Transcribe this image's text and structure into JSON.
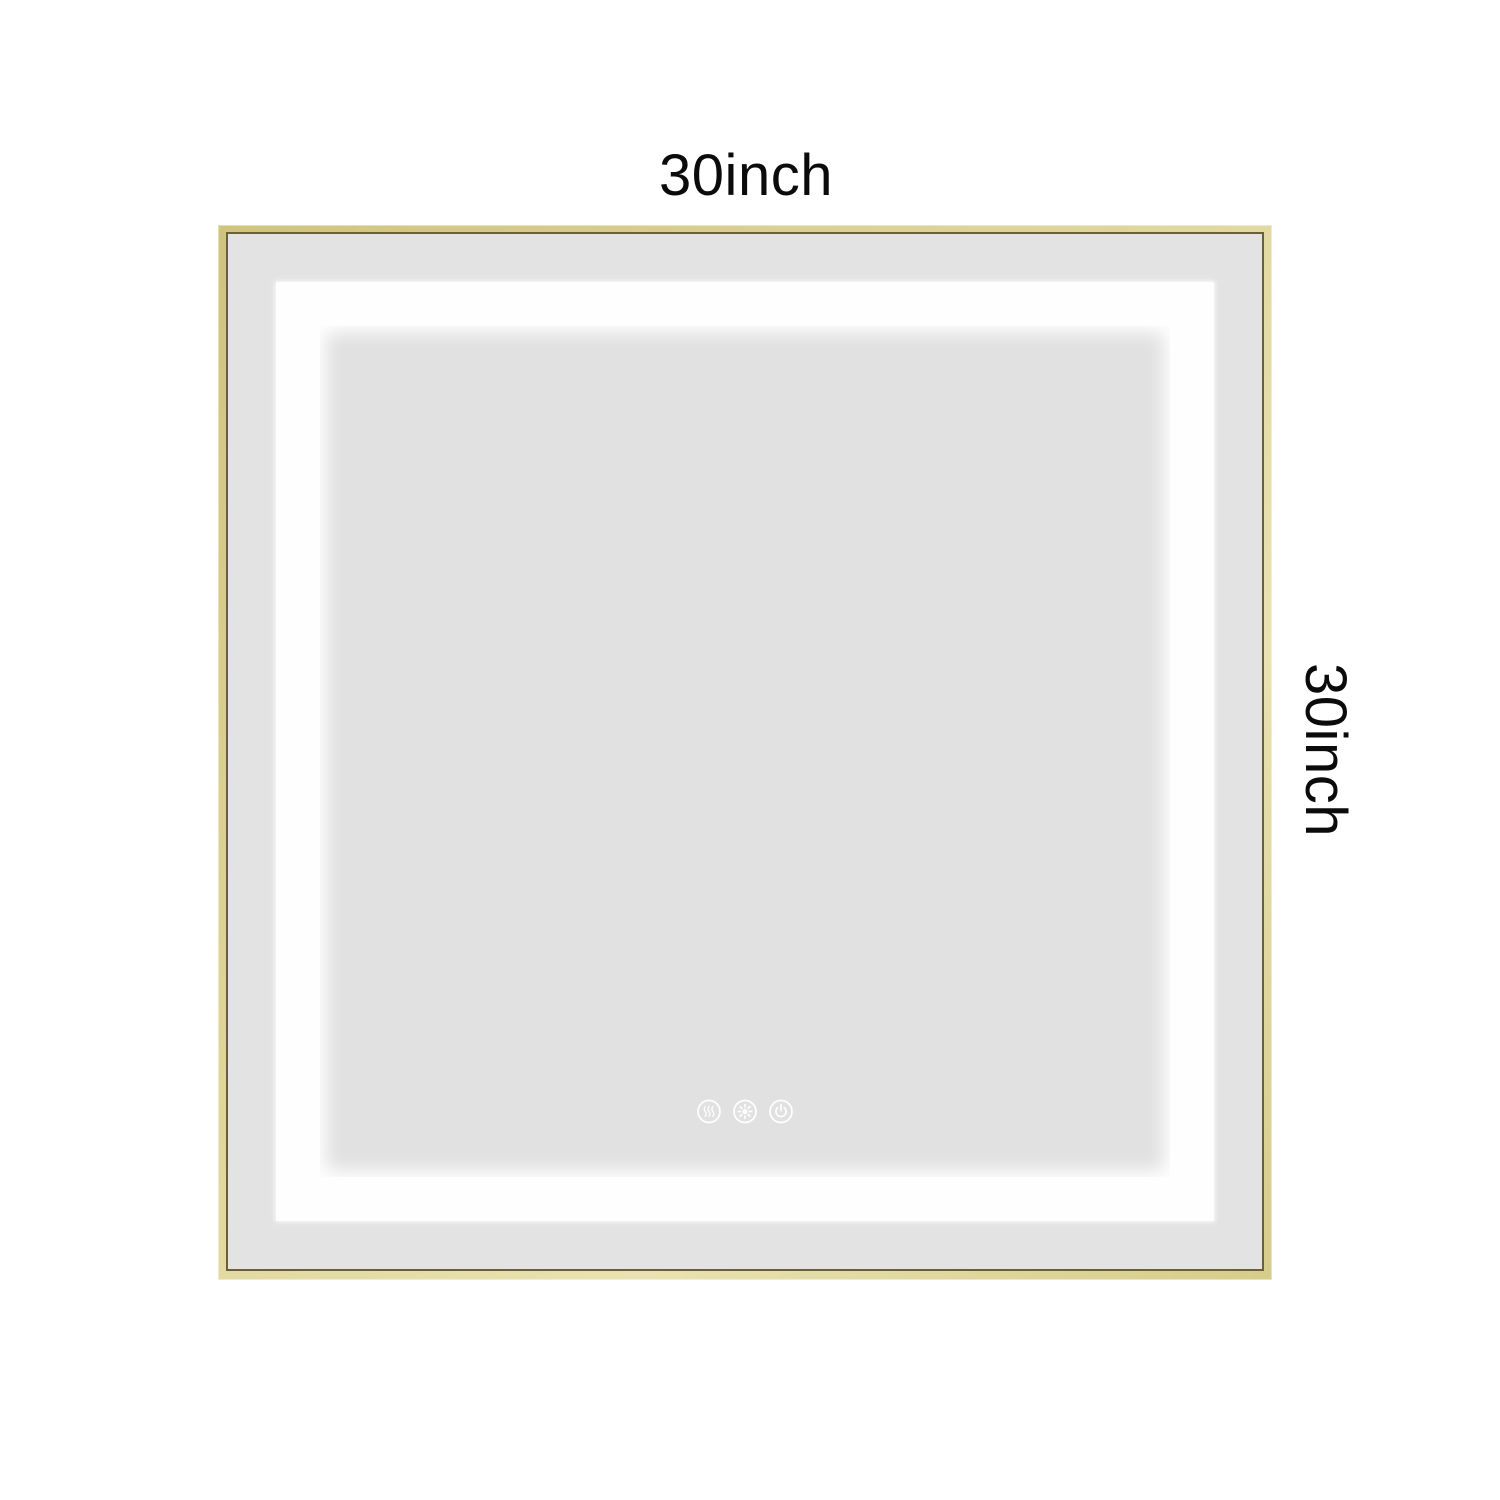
{
  "labels": {
    "width_label": "30inch",
    "height_label": "30inch"
  },
  "mirror": {
    "frame_color": "#ddd396",
    "frame_inner_line_color": "#6b5e3b",
    "outer_glass_color": "#e3e3e3",
    "led_band_color": "#fefefe",
    "inner_glass_color": "#e1e1e1"
  },
  "controls": {
    "icon_color": "#ffffff",
    "buttons": [
      {
        "name": "defog",
        "icon": "steam-waves-icon"
      },
      {
        "name": "brightness",
        "icon": "sun-icon"
      },
      {
        "name": "power",
        "icon": "power-icon"
      }
    ]
  }
}
